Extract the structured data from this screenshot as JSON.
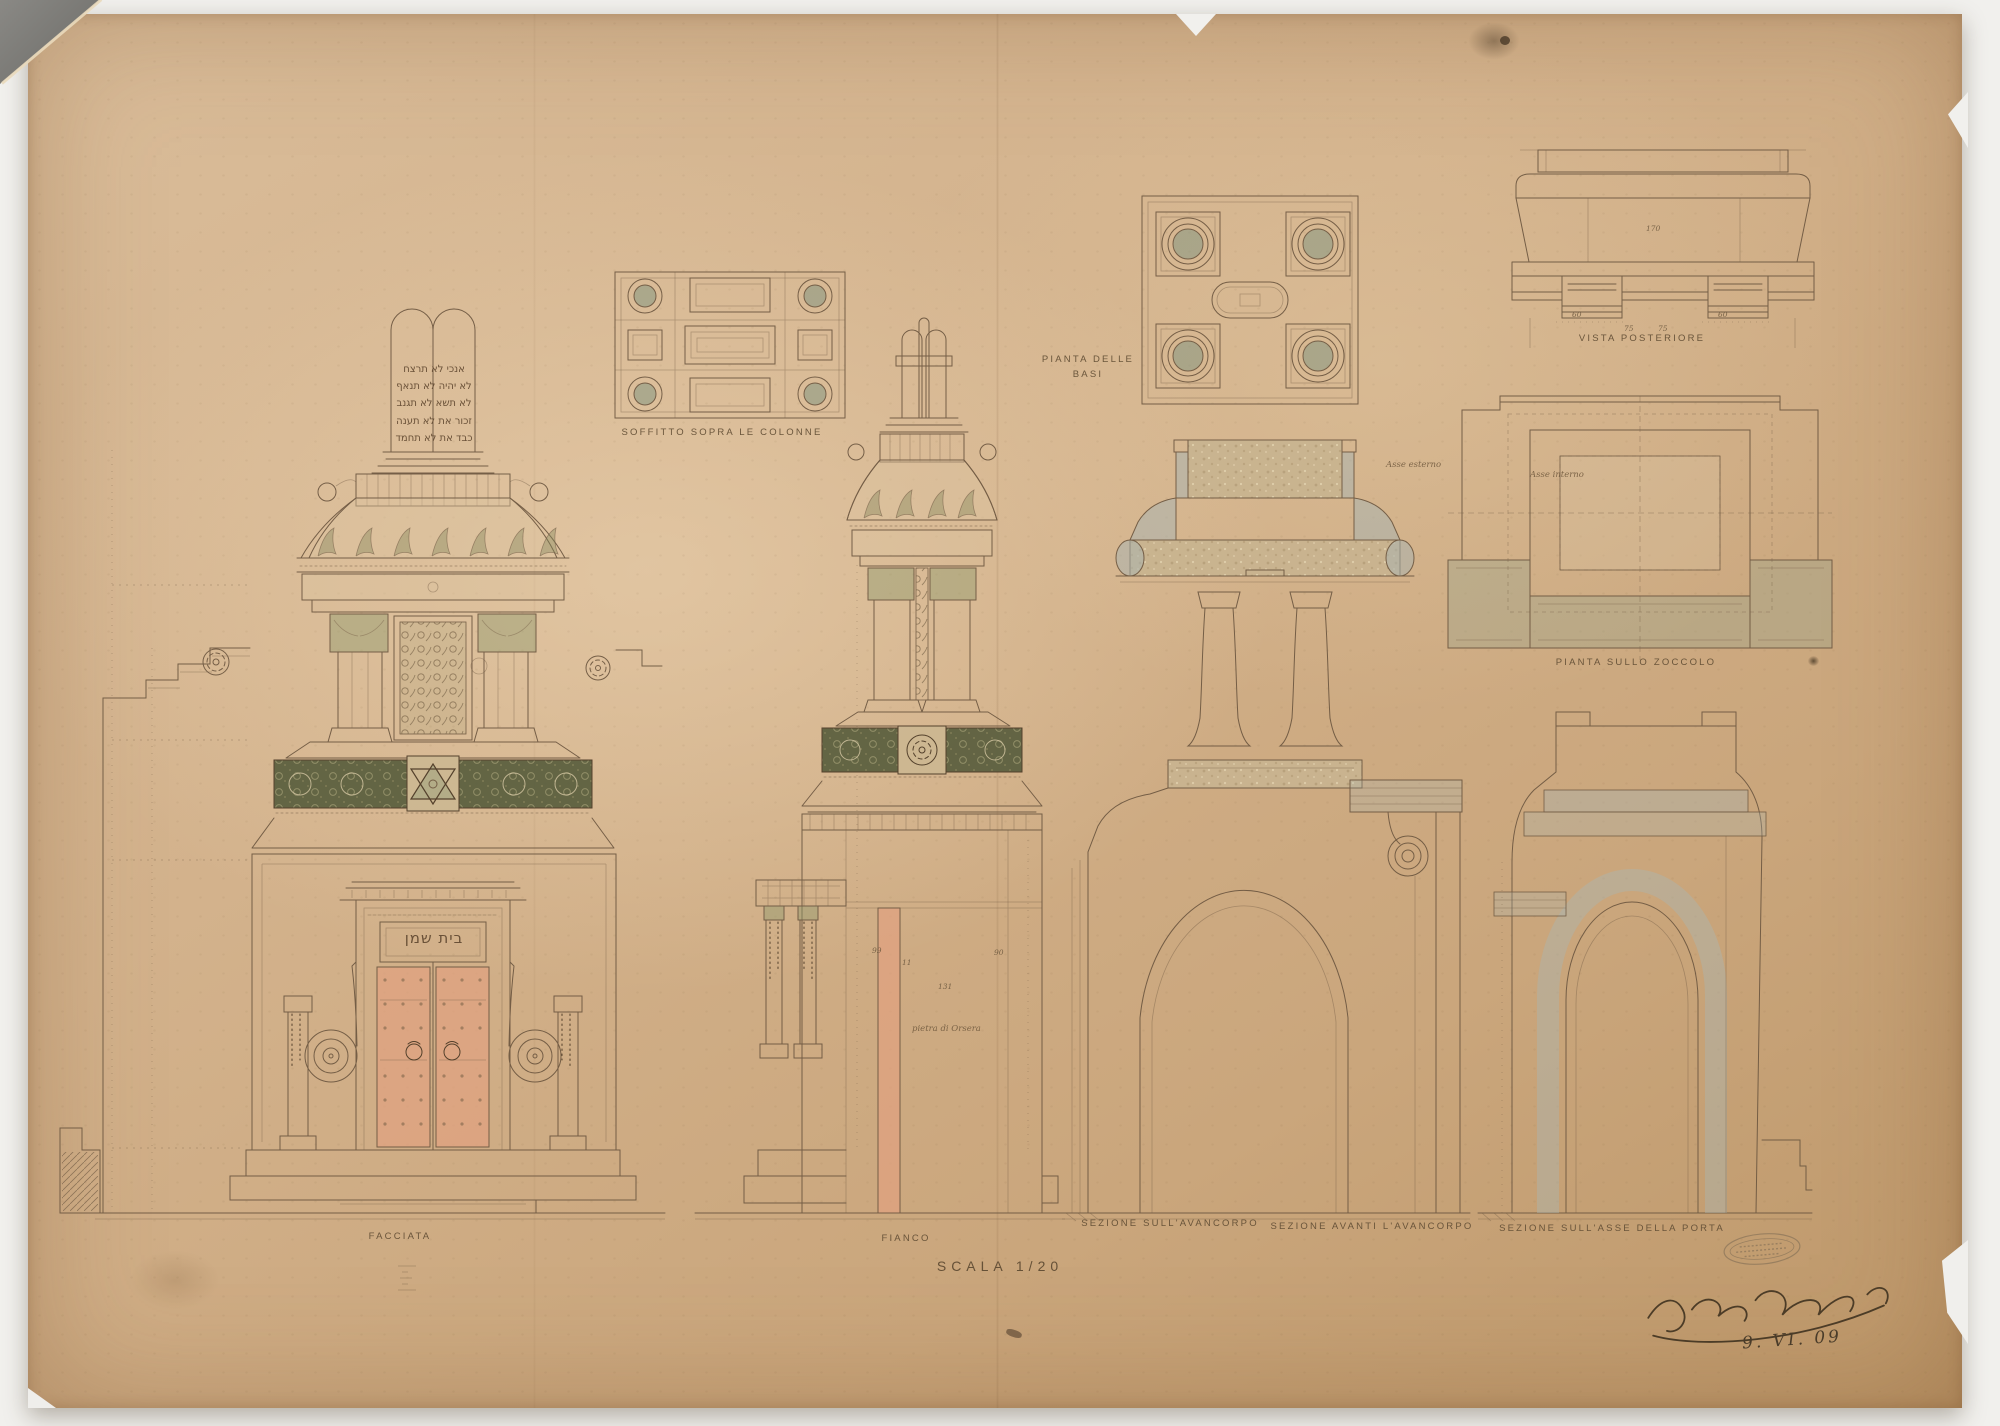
{
  "sheet": {
    "scale_note": "SCALA 1/20",
    "date": "9. VI. 09"
  },
  "views": {
    "facciata": {
      "label": "FACCIATA"
    },
    "soffitto": {
      "label": "SOFFITTO SOPRA LE COLONNE"
    },
    "fianco": {
      "label": "FIANCO"
    },
    "pianta_basi": {
      "label": "PIANTA DELLE BASI"
    },
    "vista_posteriore": {
      "label": "VISTA POSTERIORE"
    },
    "pianta_zoccolo": {
      "label": "PIANTA SULLO ZOCCOLO"
    },
    "sezione_avancorpo": {
      "label": "SEZIONE SULL'AVANCORPO"
    },
    "sezione_avanti": {
      "label": "SEZIONE AVANTI L'AVANCORPO"
    },
    "sezione_porta": {
      "label": "SEZIONE SULL'ASSE DELLA PORTA"
    }
  },
  "inscriptions": {
    "tablet_lines": [
      "אנכי  לא תרצח",
      "לא יהיה  לא תנאף",
      "לא תשא  לא תגנב",
      "זכור את  לא תענה",
      "כבד את  לא תחמד"
    ],
    "door_lintel": "בית שמן"
  },
  "annotations": {
    "material": "pietra di Orsera",
    "axis_outer": "Asse esterno",
    "axis_inner": "Asse interno",
    "dims": [
      "99",
      "11",
      "131",
      "90",
      "170",
      "60",
      "75",
      "75",
      "60"
    ]
  },
  "colors": {
    "ink": "#6f5942",
    "paper": "#d3b28c",
    "green_wash": "#8c996d",
    "blue_wash": "#a8b5b3",
    "salmon_wash": "#e2a17f",
    "olive_frieze": "#5c6040",
    "stone_speckle": "#c9b490"
  }
}
